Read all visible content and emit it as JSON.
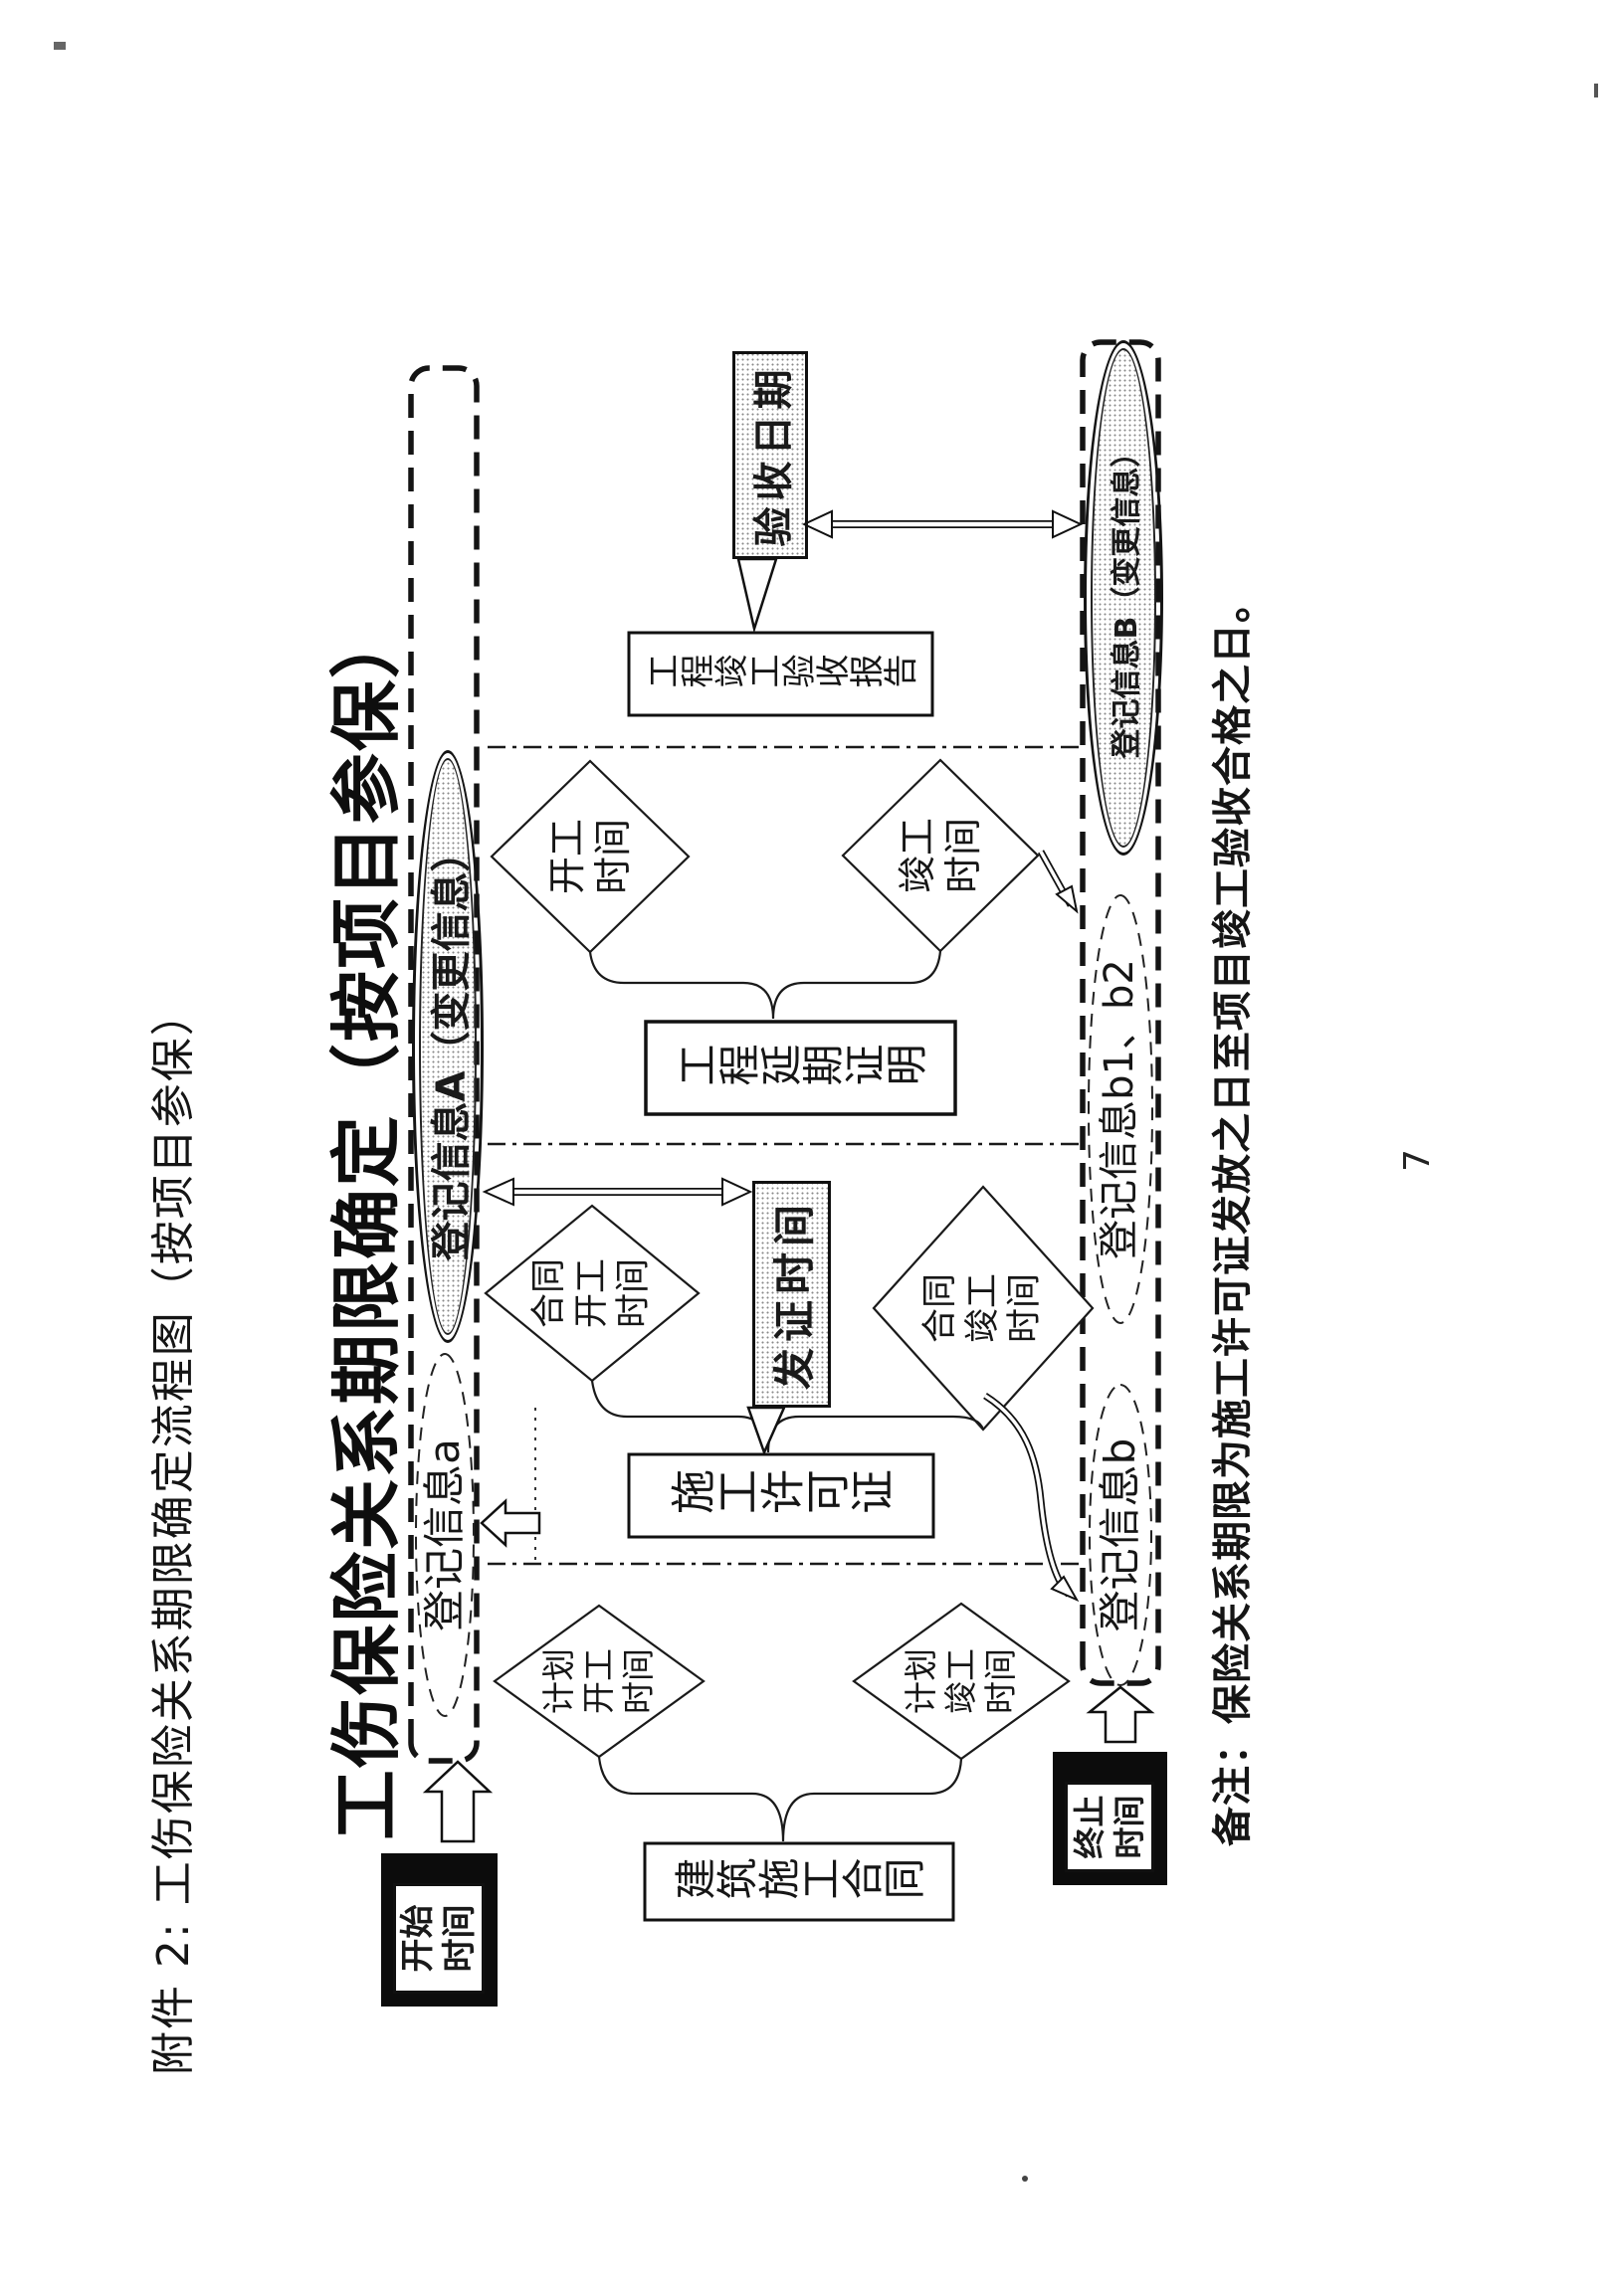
{
  "page": {
    "attachment_header": "附件 2: 工伤保险关系期限确定流程图（按项目参保）",
    "title": "工伤保险关系期限确定（按项目参保）",
    "note": "备注：保险关系期限为施工许可证发放之日至项目竣工验收合格之日。",
    "page_number": "7"
  },
  "terminals": {
    "start": "开始\n时间",
    "end": "终止\n时间"
  },
  "registration": {
    "info_a": "登记信息a",
    "info_A": "登记信息A（变更信息）",
    "info_b": "登记信息b",
    "info_b1b2": "登记信息b1、b2",
    "info_B": "登记信息B（变更信息）"
  },
  "nodes": {
    "construction_contract": "建筑施工合同",
    "planned_start": "计划\n开工\n时间",
    "planned_completion": "计划\n竣工\n时间",
    "construction_permit": "施工许可证",
    "issue_date": "发证时间",
    "contract_start": "合同\n开工\n时间",
    "contract_completion": "合同\n竣工\n时间",
    "delay_certificate": "工程延期证明",
    "actual_start": "开工\n时间",
    "actual_completion": "竣工\n时间",
    "acceptance_report": "工程竣工验收报告",
    "acceptance_date": "验收日期"
  },
  "colors": {
    "ink": "#1a1a1a",
    "paper": "#ffffff"
  }
}
